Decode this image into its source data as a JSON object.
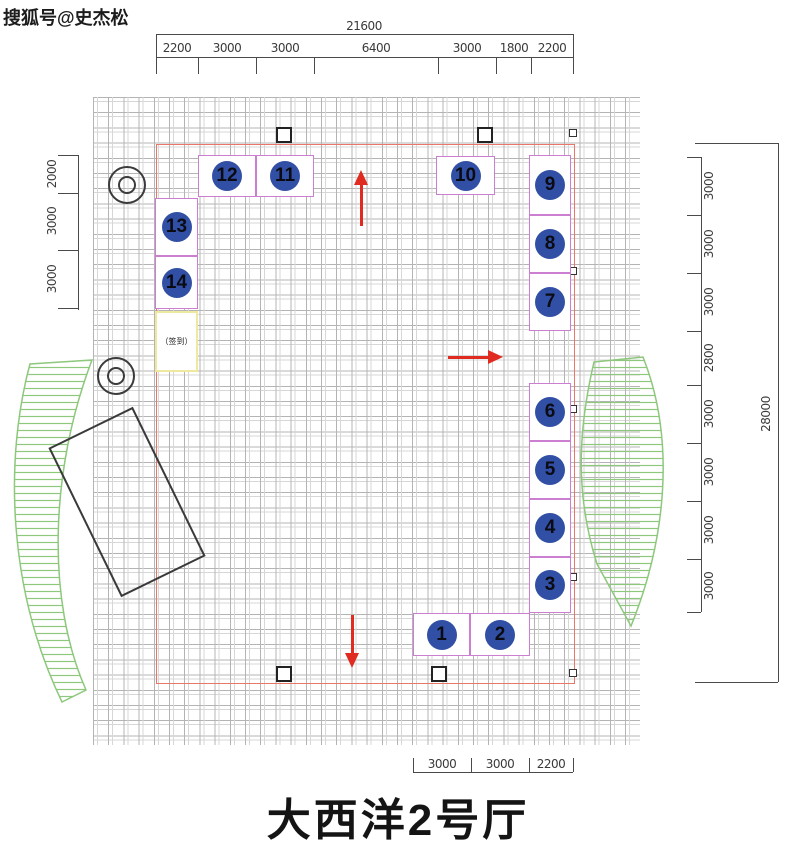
{
  "watermark": "搜狐号@史杰松",
  "title": "大西洋2号厅",
  "booths": [
    {
      "number": "1"
    },
    {
      "number": "2"
    },
    {
      "number": "3"
    },
    {
      "number": "4"
    },
    {
      "number": "5"
    },
    {
      "number": "6"
    },
    {
      "number": "7"
    },
    {
      "number": "8"
    },
    {
      "number": "9"
    },
    {
      "number": "10"
    },
    {
      "number": "11"
    },
    {
      "number": "12"
    },
    {
      "number": "13"
    },
    {
      "number": "14"
    }
  ],
  "special_booth": {
    "label": "（签到）"
  },
  "dimensions": {
    "top_total": "21600",
    "top_segments": [
      "2200",
      "3000",
      "3000",
      "6400",
      "3000",
      "1800",
      "2200"
    ],
    "left_segments": [
      "2000",
      "3000",
      "3000"
    ],
    "right_segments": [
      "3000",
      "3000",
      "3000",
      "2800",
      "3000",
      "3000",
      "3000",
      "3000"
    ],
    "right_total": "28000",
    "bottom_segments": [
      "3000",
      "3000",
      "2200"
    ]
  },
  "colors": {
    "booth_border": "#cc7fd0",
    "badge_fill": "#3150a5",
    "boundary_red": "#e8776a",
    "arrow_red": "#e02b20",
    "hatch_green": "#8dc87c",
    "special_border": "#efe9a0"
  }
}
